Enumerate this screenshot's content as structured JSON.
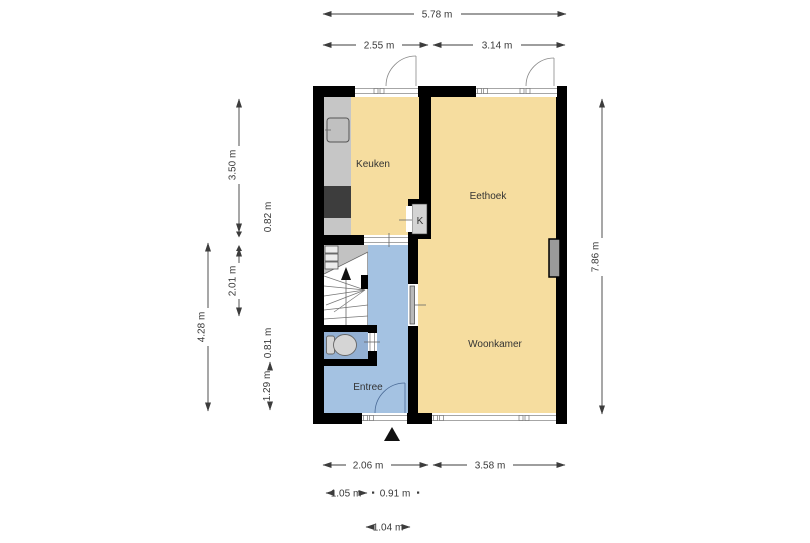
{
  "rooms": {
    "kitchen": "Keuken",
    "dining": "Eethoek",
    "living": "Woonkamer",
    "entry": "Entree",
    "closet": "K"
  },
  "dims": {
    "top_total": "5.78 m",
    "top_left": "2.55 m",
    "top_right": "3.14 m",
    "left_kitchen": "3.50 m",
    "left_counter": "0.82 m",
    "left_stairs": "2.01 m",
    "left_toilet": "0.81 m",
    "left_entry": "1.29 m",
    "left_total": "4.28 m",
    "right_total": "7.86 m",
    "bottom_left": "2.06 m",
    "bottom_right": "3.58 m",
    "bottom_d1": "1.05 m",
    "bottom_d2": "0.91 m",
    "bottom_d3": "1.04 m"
  },
  "colors": {
    "wall": "#000000",
    "room": "#f6dd9f",
    "hall": "#a4c2e2",
    "toilet": "#93b0d3",
    "counter": "#c6c6c6",
    "stairs_gray": "#c2c2c2",
    "appliance_dark": "#3d3d3d",
    "dim_text": "#3a3a3a"
  }
}
